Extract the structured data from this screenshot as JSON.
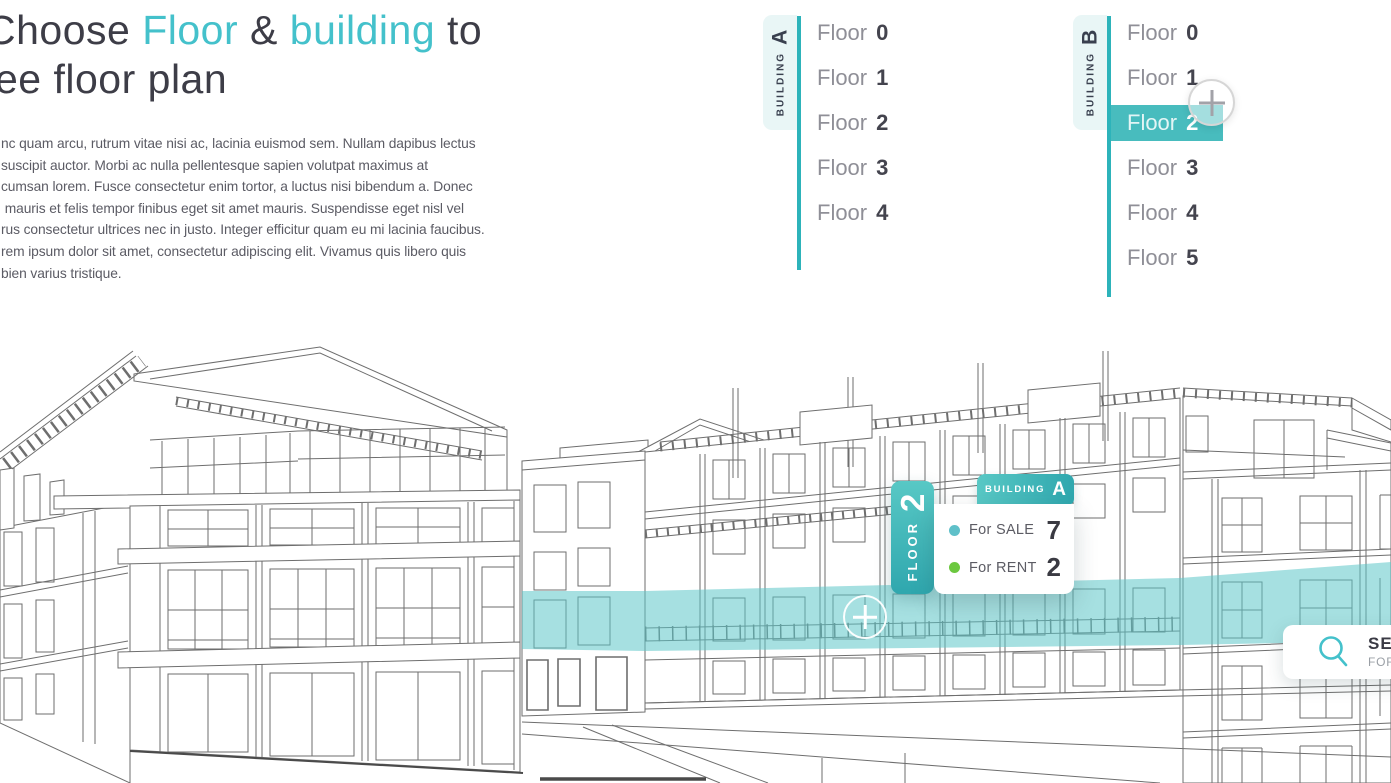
{
  "header": {
    "heading": {
      "part1": "Choose ",
      "accent1": "Floor",
      "part2": " & ",
      "accent2": "building",
      "part3": " to",
      "line2": "see floor plan"
    }
  },
  "intro": {
    "lines": [
      "nc quam arcu, rutrum vitae nisi ac, lacinia euismod sem. Nullam dapibus lectus",
      "suscipit auctor. Morbi ac nulla pellentesque sapien volutpat maximus at",
      "cumsan lorem. Fusce consectetur enim tortor, a luctus nisi bibendum a. Donec",
      " mauris et felis tempor finibus eget sit amet mauris. Suspendisse eget nisl vel",
      "rus consectetur ultrices nec in justo. Integer efficitur quam eu mi lacinia faucibus.",
      "rem ipsum dolor sit amet, consectetur adipiscing elit. Vivamus quis libero quis",
      "bien varius tristique."
    ]
  },
  "building_a": {
    "tab_label": "BUILDING",
    "tab_letter": "A",
    "floors": [
      {
        "label": "Floor",
        "number": "0"
      },
      {
        "label": "Floor",
        "number": "1"
      },
      {
        "label": "Floor",
        "number": "2"
      },
      {
        "label": "Floor",
        "number": "3"
      },
      {
        "label": "Floor",
        "number": "4"
      }
    ]
  },
  "building_b": {
    "tab_label": "BUILDING",
    "tab_letter": "B",
    "selected_floor": "Floor 2",
    "floors": [
      {
        "label": "Floor",
        "number": "0"
      },
      {
        "label": "Floor",
        "number": "1"
      },
      {
        "label": "Floor",
        "number": "2"
      },
      {
        "label": "Floor",
        "number": "3"
      },
      {
        "label": "Floor",
        "number": "4"
      },
      {
        "label": "Floor",
        "number": "5"
      }
    ]
  },
  "tooltip": {
    "floor_label": "FLOOR",
    "floor_number": "2",
    "building_label": "BUILDING",
    "building_letter": "A",
    "stats": [
      {
        "label": "For SALE",
        "value": "7"
      },
      {
        "label": "For RENT",
        "value": "2"
      }
    ]
  },
  "search": {
    "line1": "SEA",
    "line2": "FOR"
  },
  "colors": {
    "accent": "#44c1cb",
    "teal_line": "#2db3ba",
    "selected_row": "#48bcbe",
    "tab_bg": "#e9f6f6",
    "tooltip_teal_1": "#58c8c5",
    "tooltip_teal_2": "#2fa7ae",
    "highlight": "#5cc7c8",
    "dot_sale": "#5fc0c9",
    "dot_rent": "#6cc83f",
    "heading_color": "#3d3d47",
    "body_color": "#5b5b64",
    "floor_label": "#8f8f97",
    "floor_number": "#44444e",
    "line_art": "#6e6e6e"
  }
}
